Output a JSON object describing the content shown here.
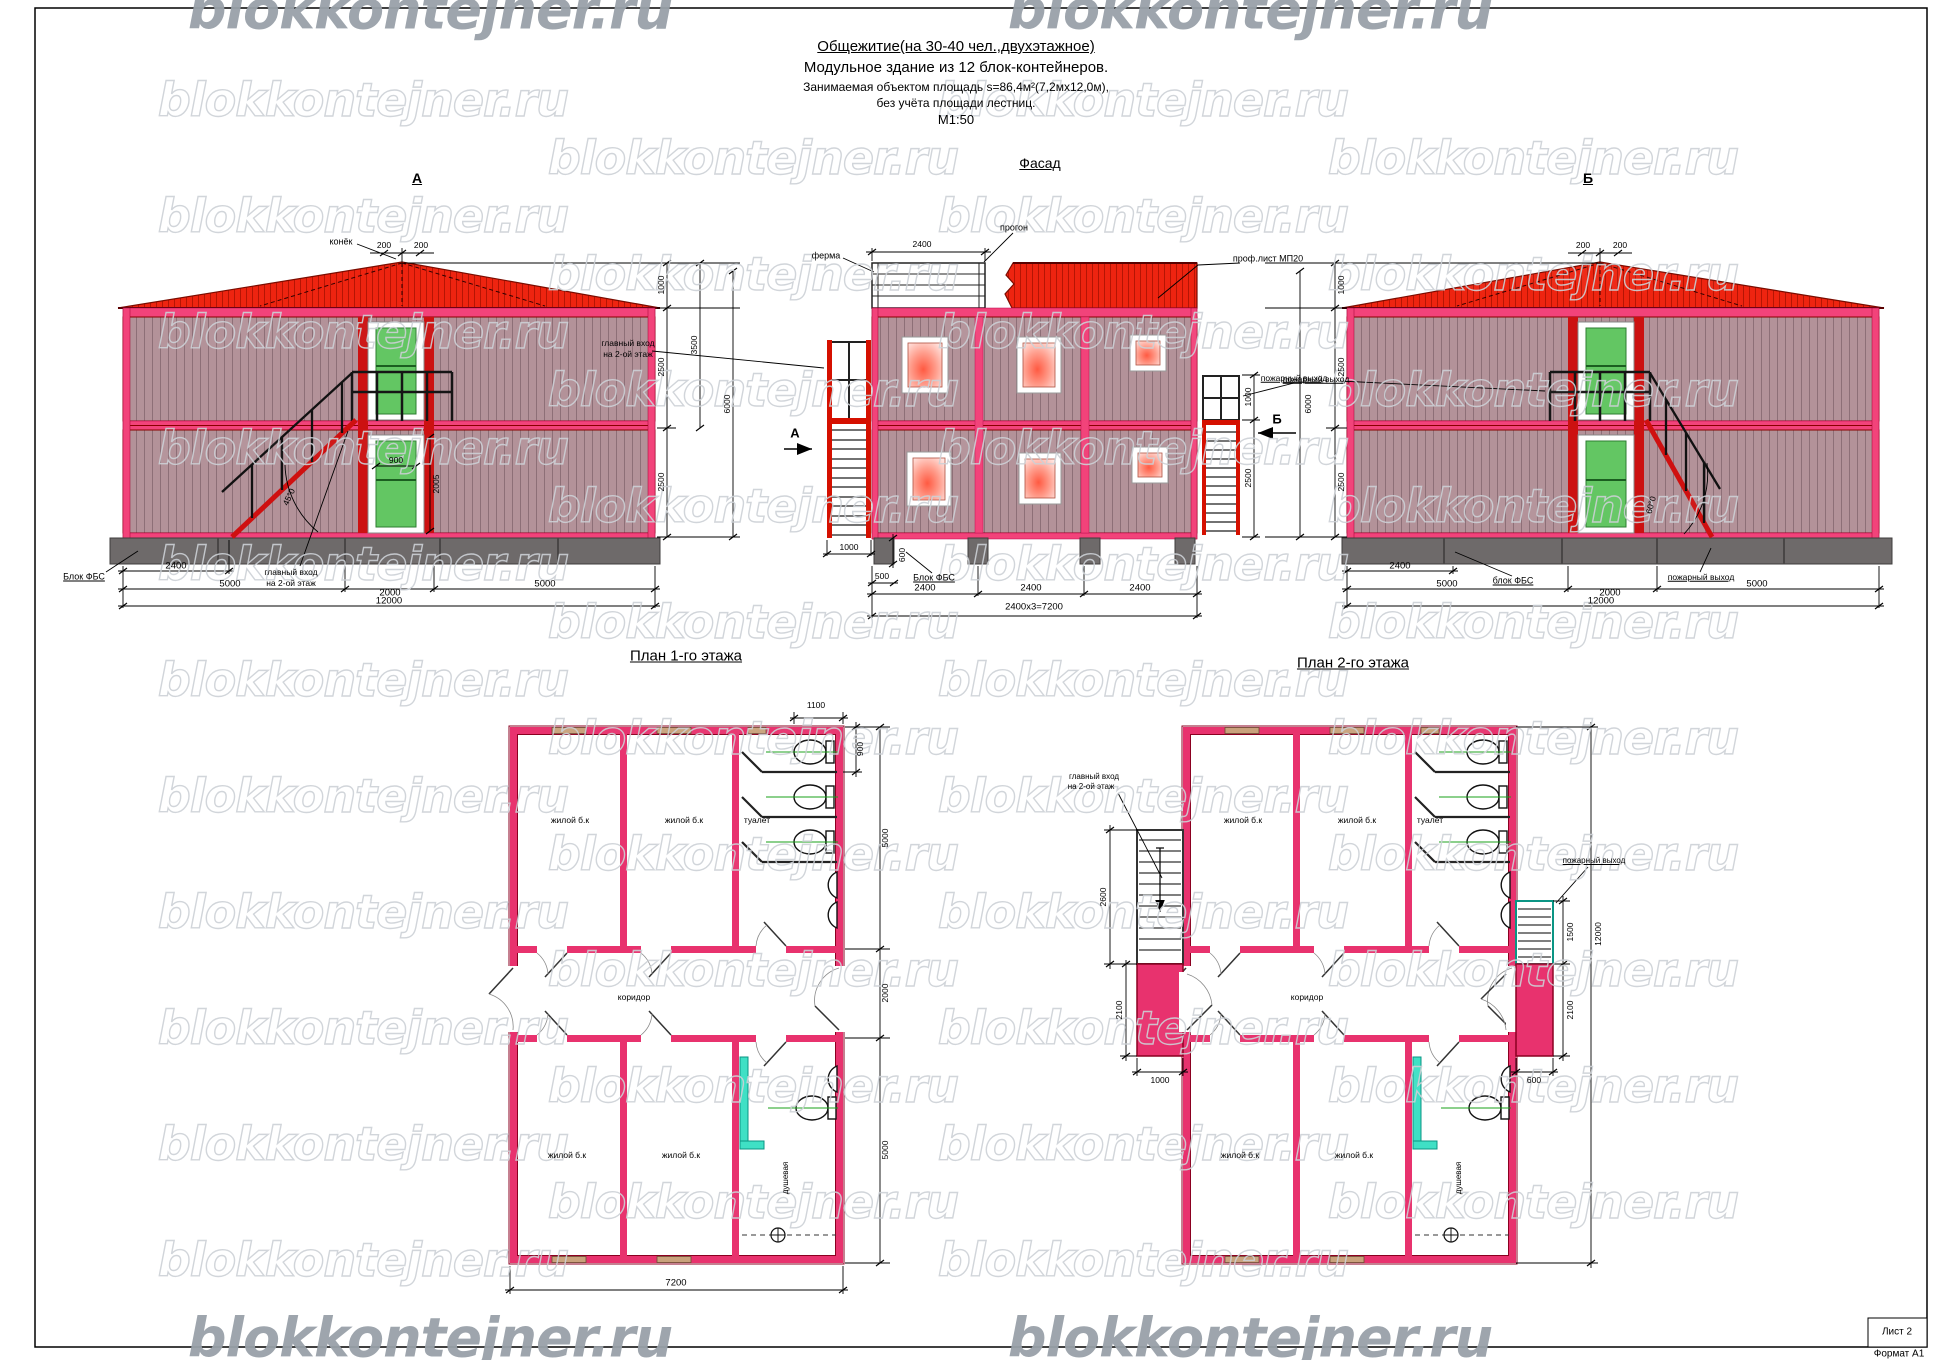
{
  "watermark": {
    "text": "blokkontejner.ru"
  },
  "header": {
    "title": "Общежитие(на 30-40 чел.,двухэтажное)",
    "subtitle": "Модульное  здание из 12 блок-контейнеров.",
    "area_line": "Занимаемая объектом площадь    s=86,4м²(7,2мх12,0м),",
    "area_note": "без учёта площади лестниц.",
    "scale": "М1:50"
  },
  "sheet": {
    "sheet_label": "Лист 2",
    "format_label": "Формат А1"
  },
  "colors": {
    "accent_crimson": "#e8326e",
    "roof_red": "#ef2410",
    "wall_mauve": "#b39299",
    "door_green": "#63c663",
    "shower_teal": "#3fe0c5",
    "foundation_gray": "#6e6a6a"
  },
  "annotations": [
    {
      "n": "view-title-elevation-a",
      "t": "А",
      "x": 417,
      "y": 178,
      "fs": 14,
      "b": 1,
      "u": 1
    },
    {
      "n": "view-title-facade",
      "t": "Фасад",
      "x": 1040,
      "y": 163,
      "fs": 14,
      "u": 1
    },
    {
      "n": "view-title-elevation-b",
      "t": "Б",
      "x": 1588,
      "y": 178,
      "fs": 14,
      "b": 1,
      "u": 1
    },
    {
      "n": "view-title-plan1",
      "t": "План  1-го этажа",
      "x": 686,
      "y": 656,
      "fs": 15,
      "u": 1
    },
    {
      "n": "view-title-plan2",
      "t": "План  2-го этажа",
      "x": 1353,
      "y": 663,
      "fs": 15,
      "u": 1
    },
    {
      "n": "callout-konek",
      "t": "конёк",
      "x": 341,
      "y": 242,
      "fs": 9
    },
    {
      "t": "200",
      "x": 384,
      "y": 245,
      "fs": 8.5
    },
    {
      "t": "200",
      "x": 421,
      "y": 245,
      "fs": 8.5
    },
    {
      "t": "1000",
      "x": 661,
      "y": 285,
      "fs": 8.5,
      "r": -90
    },
    {
      "t": "2500",
      "x": 661,
      "y": 367,
      "fs": 8.5,
      "r": -90
    },
    {
      "t": "2500",
      "x": 661,
      "y": 482,
      "fs": 8.5,
      "r": -90
    },
    {
      "t": "3500",
      "x": 694,
      "y": 345,
      "fs": 8.5,
      "r": -90
    },
    {
      "t": "6000",
      "x": 727,
      "y": 404,
      "fs": 8.5,
      "r": -90
    },
    {
      "t": "900",
      "x": 396,
      "y": 460,
      "fs": 8.5
    },
    {
      "t": "2005",
      "x": 436,
      "y": 484,
      "fs": 8.5,
      "r": -90
    },
    {
      "t": "45°0",
      "x": 289,
      "y": 497,
      "fs": 8.5,
      "r": -65
    },
    {
      "n": "callout-blok-fbs-a",
      "t": "Блок ФБС",
      "x": 84,
      "y": 577,
      "fs": 9,
      "u": 1
    },
    {
      "t": "2400",
      "x": 176,
      "y": 566,
      "fs": 9.5
    },
    {
      "n": "callout-main-entrance-a1",
      "t": "главный вход",
      "x": 291,
      "y": 572,
      "fs": 8.5
    },
    {
      "n": "callout-main-entrance-a2",
      "t": "на 2-ой этаж",
      "x": 291,
      "y": 583,
      "fs": 8.5
    },
    {
      "t": "5000",
      "x": 230,
      "y": 584,
      "fs": 9.5
    },
    {
      "t": "2000",
      "x": 390,
      "y": 593,
      "fs": 9.5
    },
    {
      "t": "5000",
      "x": 545,
      "y": 584,
      "fs": 9.5
    },
    {
      "t": "12000",
      "x": 389,
      "y": 601,
      "fs": 9.5
    },
    {
      "n": "callout-ferma",
      "t": "ферма",
      "x": 826,
      "y": 256,
      "fs": 9
    },
    {
      "t": "2400",
      "x": 922,
      "y": 244,
      "fs": 8.5
    },
    {
      "n": "callout-progon",
      "t": "прогон",
      "x": 1014,
      "y": 228,
      "fs": 9
    },
    {
      "n": "callout-profsheet",
      "t": "проф.лист МП20",
      "x": 1268,
      "y": 259,
      "fs": 9
    },
    {
      "n": "callout-main-entrance-f1",
      "t": "главный вход",
      "x": 628,
      "y": 343,
      "fs": 8.5
    },
    {
      "n": "callout-main-entrance-f2",
      "t": "на 2-ой этаж",
      "x": 628,
      "y": 354,
      "fs": 8.5
    },
    {
      "n": "section-marker-a",
      "t": "А",
      "x": 795,
      "y": 433,
      "fs": 13,
      "b": 1
    },
    {
      "n": "section-marker-b",
      "t": "Б",
      "x": 1277,
      "y": 419,
      "fs": 13,
      "b": 1
    },
    {
      "n": "callout-fire-exit-f",
      "t": "пожарный выход",
      "x": 1316,
      "y": 379,
      "fs": 8.5,
      "u": 1
    },
    {
      "t": "1000",
      "x": 1248,
      "y": 397,
      "fs": 8.5,
      "r": -90
    },
    {
      "t": "2500",
      "x": 1248,
      "y": 478,
      "fs": 8.5,
      "r": -90
    },
    {
      "t": "1000",
      "x": 849,
      "y": 547,
      "fs": 8.5
    },
    {
      "t": "600",
      "x": 902,
      "y": 555,
      "fs": 8.5,
      "r": -90
    },
    {
      "t": "500",
      "x": 882,
      "y": 576,
      "fs": 8.5
    },
    {
      "n": "callout-blok-fbs-f",
      "t": "Блок ФБС",
      "x": 934,
      "y": 578,
      "fs": 9,
      "u": 1
    },
    {
      "t": "2400",
      "x": 925,
      "y": 588,
      "fs": 9.5
    },
    {
      "t": "2400",
      "x": 1031,
      "y": 588,
      "fs": 9.5
    },
    {
      "t": "2400",
      "x": 1140,
      "y": 588,
      "fs": 9.5
    },
    {
      "t": "2400х3=7200",
      "x": 1034,
      "y": 607,
      "fs": 9.5
    },
    {
      "t": "200",
      "x": 1583,
      "y": 245,
      "fs": 8.5
    },
    {
      "t": "200",
      "x": 1620,
      "y": 245,
      "fs": 8.5
    },
    {
      "n": "callout-fire-exit-b-top",
      "t": "пожарный выход",
      "x": 1294,
      "y": 378,
      "fs": 8.5,
      "u": 1
    },
    {
      "t": "1000",
      "x": 1341,
      "y": 285,
      "fs": 8.5,
      "r": -90
    },
    {
      "t": "2500",
      "x": 1341,
      "y": 367,
      "fs": 8.5,
      "r": -90
    },
    {
      "t": "2500",
      "x": 1341,
      "y": 482,
      "fs": 8.5,
      "r": -90
    },
    {
      "t": "6000",
      "x": 1308,
      "y": 404,
      "fs": 8.5,
      "r": -90
    },
    {
      "t": "60°0",
      "x": 1651,
      "y": 505,
      "fs": 8.5,
      "r": -75
    },
    {
      "t": "2400",
      "x": 1400,
      "y": 566,
      "fs": 9.5
    },
    {
      "t": "5000",
      "x": 1447,
      "y": 584,
      "fs": 9.5
    },
    {
      "n": "callout-blok-fbs-b",
      "t": "блок ФБС",
      "x": 1513,
      "y": 581,
      "fs": 9,
      "u": 1
    },
    {
      "t": "2000",
      "x": 1610,
      "y": 593,
      "fs": 9.5
    },
    {
      "n": "callout-fire-exit-b-bottom",
      "t": "пожарный выход",
      "x": 1701,
      "y": 577,
      "fs": 8.5,
      "u": 1
    },
    {
      "t": "5000",
      "x": 1757,
      "y": 584,
      "fs": 9.5
    },
    {
      "t": "12000",
      "x": 1601,
      "y": 601,
      "fs": 9.5
    },
    {
      "t": "1100",
      "x": 816,
      "y": 705,
      "fs": 8.5
    },
    {
      "t": "900",
      "x": 860,
      "y": 749,
      "fs": 8.5,
      "r": -90
    },
    {
      "t": "5000",
      "x": 885,
      "y": 838,
      "fs": 8.5,
      "r": -90
    },
    {
      "t": "2000",
      "x": 885,
      "y": 993,
      "fs": 8.5,
      "r": -90
    },
    {
      "t": "5000",
      "x": 885,
      "y": 1150,
      "fs": 8.5,
      "r": -90
    },
    {
      "t": "7200",
      "x": 676,
      "y": 1283,
      "fs": 9.5
    },
    {
      "n": "room-zhiloy-1a",
      "t": "жилой б.к",
      "x": 570,
      "y": 820,
      "fs": 8.5
    },
    {
      "n": "room-zhiloy-1b",
      "t": "жилой б.к",
      "x": 684,
      "y": 820,
      "fs": 8.5
    },
    {
      "n": "room-tualet-1",
      "t": "туалет",
      "x": 757,
      "y": 820,
      "fs": 8.5
    },
    {
      "n": "room-koridor-1",
      "t": "коридор",
      "x": 634,
      "y": 997,
      "fs": 8.5
    },
    {
      "n": "room-zhiloy-1c",
      "t": "жилой б.к",
      "x": 567,
      "y": 1155,
      "fs": 8.5
    },
    {
      "n": "room-zhiloy-1d",
      "t": "жилой б.к",
      "x": 681,
      "y": 1155,
      "fs": 8.5
    },
    {
      "n": "room-dushevaya-1",
      "t": "душевая",
      "x": 786,
      "y": 1178,
      "fs": 8,
      "r": -90
    },
    {
      "n": "callout-main-entrance-p1",
      "t": "главный вход",
      "x": 1094,
      "y": 777,
      "fs": 8
    },
    {
      "n": "callout-main-entrance-p2",
      "t": "на 2-ой этаж",
      "x": 1091,
      "y": 787,
      "fs": 8
    },
    {
      "t": "2600",
      "x": 1103,
      "y": 897,
      "fs": 8.5,
      "r": -90
    },
    {
      "t": "2100",
      "x": 1119,
      "y": 1010,
      "fs": 8.5,
      "r": -90
    },
    {
      "t": "1000",
      "x": 1160,
      "y": 1080,
      "fs": 8.5
    },
    {
      "n": "callout-fire-exit-p",
      "t": "пожарный выход",
      "x": 1594,
      "y": 861,
      "fs": 8,
      "u": 1
    },
    {
      "t": "1500",
      "x": 1570,
      "y": 932,
      "fs": 8.5,
      "r": -90
    },
    {
      "t": "2100",
      "x": 1570,
      "y": 1010,
      "fs": 8.5,
      "r": -90
    },
    {
      "t": "600",
      "x": 1534,
      "y": 1080,
      "fs": 8.5
    },
    {
      "t": "12000",
      "x": 1598,
      "y": 934,
      "fs": 8.5,
      "r": -90
    },
    {
      "n": "room-zhiloy-2a",
      "t": "жилой б.к",
      "x": 1243,
      "y": 820,
      "fs": 8.5
    },
    {
      "n": "room-zhiloy-2b",
      "t": "жилой б.к",
      "x": 1357,
      "y": 820,
      "fs": 8.5
    },
    {
      "n": "room-tualet-2",
      "t": "туалет",
      "x": 1430,
      "y": 820,
      "fs": 8.5
    },
    {
      "n": "room-koridor-2",
      "t": "коридор",
      "x": 1307,
      "y": 997,
      "fs": 8.5
    },
    {
      "n": "room-zhiloy-2c",
      "t": "жилой б.к",
      "x": 1240,
      "y": 1155,
      "fs": 8.5
    },
    {
      "n": "room-zhiloy-2d",
      "t": "жилой б.к",
      "x": 1354,
      "y": 1155,
      "fs": 8.5
    },
    {
      "n": "room-dushevaya-2",
      "t": "душевая",
      "x": 1459,
      "y": 1178,
      "fs": 8,
      "r": -90
    }
  ]
}
